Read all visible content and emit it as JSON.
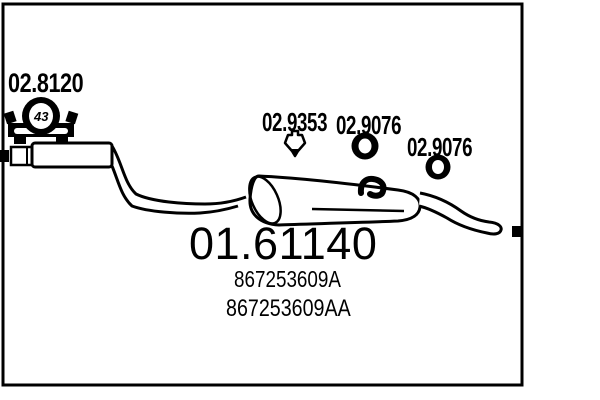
{
  "colors": {
    "ink": "#000000",
    "background": "#ffffff"
  },
  "diagram": {
    "main_part_code": "01.61140",
    "oem_numbers": [
      "867253609A",
      "867253609AA"
    ],
    "callouts": [
      {
        "code": "02.8120",
        "icon": "clamp-icon",
        "badge": "43"
      },
      {
        "code": "02.9353",
        "icon": "hanger-icon"
      },
      {
        "code": "02.9076",
        "icon": "gasket-ring-icon"
      },
      {
        "code": "02.9076",
        "icon": "gasket-ring-icon"
      }
    ]
  }
}
